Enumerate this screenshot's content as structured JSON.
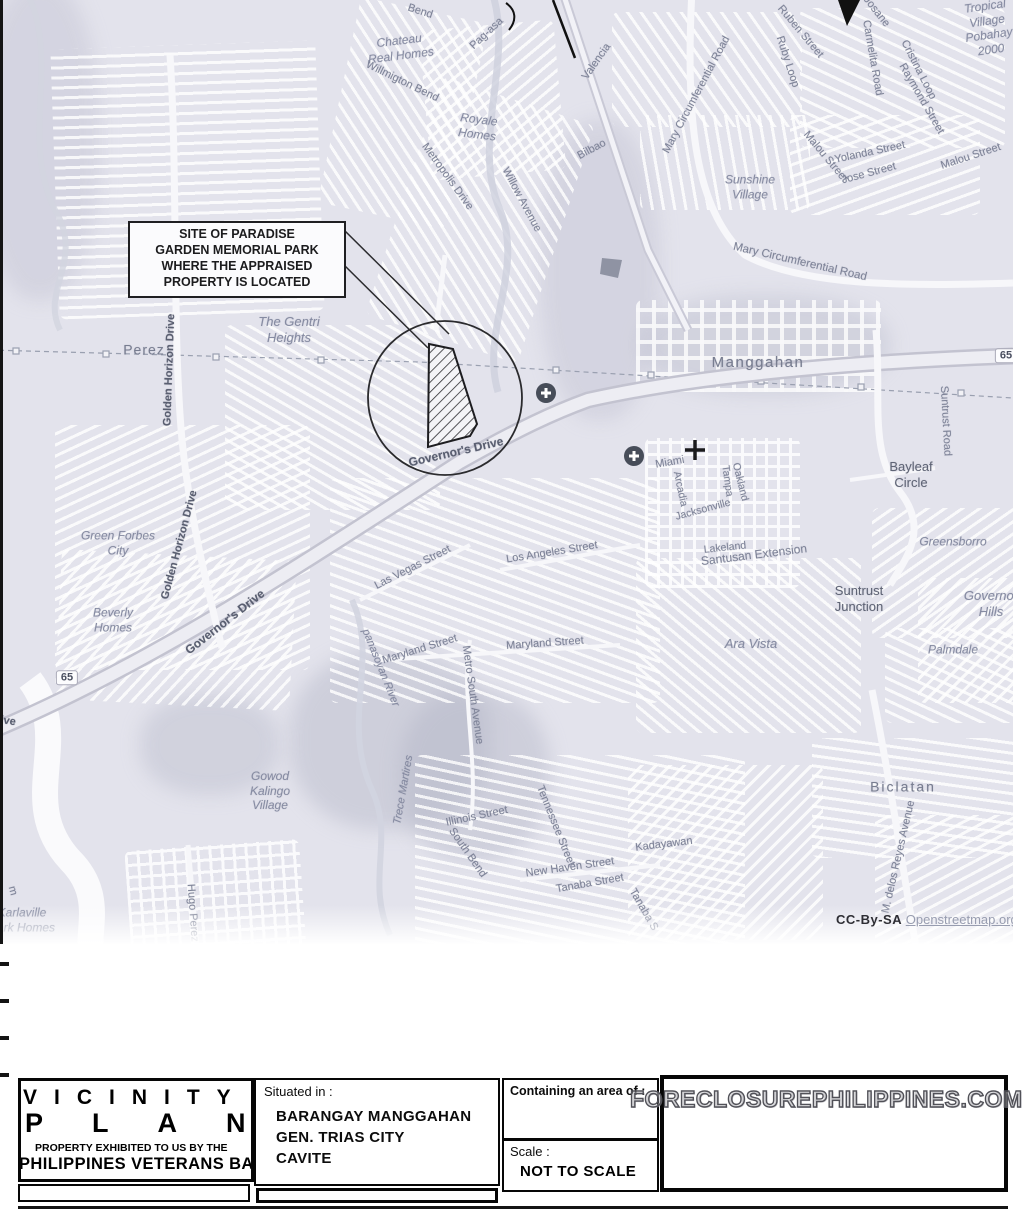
{
  "map": {
    "callout_text": "SITE OF PARADISE\nGARDEN MEMORIAL PARK\nWHERE THE APPRAISED\nPROPERTY IS LOCATED",
    "attribution": {
      "prefix": "CC-By-SA",
      "link": "Openstreetmap.org"
    },
    "labels": [
      {
        "t": "Bend",
        "x": 420,
        "y": 12,
        "r": 18,
        "s": 11,
        "c": "road"
      },
      {
        "t": "Pag-asa",
        "x": 487,
        "y": 34,
        "r": -43,
        "s": 11,
        "c": "road"
      },
      {
        "t": "Chateau\nReal Homes",
        "x": 400,
        "y": 48,
        "r": -7,
        "s": 12,
        "c": "place"
      },
      {
        "t": "Willmigton Bend",
        "x": 402,
        "y": 82,
        "r": 26,
        "s": 11,
        "c": "road"
      },
      {
        "t": "Royale\nHomes",
        "x": 478,
        "y": 127,
        "r": 7,
        "s": 12,
        "c": "place"
      },
      {
        "t": "Metropolis Drive",
        "x": 447,
        "y": 177,
        "r": 54,
        "s": 11,
        "c": "road"
      },
      {
        "t": "Willow Avenue",
        "x": 521,
        "y": 200,
        "r": 62,
        "s": 11,
        "c": "road"
      },
      {
        "t": "Valencia",
        "x": 597,
        "y": 62,
        "r": -55,
        "s": 11,
        "c": "road"
      },
      {
        "t": "Bilbao",
        "x": 592,
        "y": 150,
        "r": -28,
        "s": 11,
        "c": "road"
      },
      {
        "t": "Mary Circumferential Road",
        "x": 697,
        "y": 95,
        "r": -62,
        "s": 11,
        "c": "road"
      },
      {
        "t": "Ruben Street",
        "x": 800,
        "y": 32,
        "r": 50,
        "s": 11,
        "c": "road"
      },
      {
        "t": "Ruby Loop",
        "x": 787,
        "y": 62,
        "r": 72,
        "s": 11,
        "c": "road"
      },
      {
        "t": "Josane",
        "x": 876,
        "y": 12,
        "r": 52,
        "s": 11,
        "c": "road"
      },
      {
        "t": "Carmelita Road",
        "x": 872,
        "y": 58,
        "r": 80,
        "s": 11,
        "c": "road"
      },
      {
        "t": "Cristina Loop",
        "x": 918,
        "y": 70,
        "r": 63,
        "s": 11,
        "c": "road"
      },
      {
        "t": "Raymond Street",
        "x": 921,
        "y": 99,
        "r": 60,
        "s": 11,
        "c": "road"
      },
      {
        "t": "Tropical\nVillage\nPobahay\n2000",
        "x": 988,
        "y": 28,
        "r": -8,
        "s": 12,
        "c": "place"
      },
      {
        "t": "Malou Street",
        "x": 825,
        "y": 157,
        "r": 50,
        "s": 11,
        "c": "road"
      },
      {
        "t": "Yolanda Street",
        "x": 870,
        "y": 153,
        "r": -12,
        "s": 11,
        "c": "road"
      },
      {
        "t": "Jose Street",
        "x": 869,
        "y": 174,
        "r": -15,
        "s": 11,
        "c": "road"
      },
      {
        "t": "Malou Street",
        "x": 971,
        "y": 157,
        "r": -18,
        "s": 11,
        "c": "road"
      },
      {
        "t": "Sunshine\nVillage",
        "x": 750,
        "y": 187,
        "r": 0,
        "s": 12,
        "c": "place"
      },
      {
        "t": "Mary Circumferential Road",
        "x": 800,
        "y": 262,
        "r": 13,
        "s": 11.5,
        "c": "road"
      },
      {
        "t": "Manggahan",
        "x": 758,
        "y": 363,
        "r": 0,
        "s": 15,
        "c": "town",
        "ls": 1.5
      },
      {
        "t": "65",
        "x": 67,
        "y": 678,
        "r": 0,
        "s": 11,
        "c": "shield"
      },
      {
        "t": "65",
        "x": 1006,
        "y": 356,
        "r": 0,
        "s": 11,
        "c": "shield"
      },
      {
        "t": "Suntrust Road",
        "x": 945,
        "y": 421,
        "r": 87,
        "s": 11,
        "c": "road"
      },
      {
        "t": "Bayleaf\nCircle",
        "x": 911,
        "y": 475,
        "r": 0,
        "s": 13,
        "c": "dark"
      },
      {
        "t": "Greensborro",
        "x": 953,
        "y": 542,
        "r": 0,
        "s": 12,
        "c": "place"
      },
      {
        "t": "Governor\nHills",
        "x": 991,
        "y": 604,
        "r": 0,
        "s": 13,
        "c": "place"
      },
      {
        "t": "Suntrust\nJunction",
        "x": 859,
        "y": 599,
        "r": 0,
        "s": 13,
        "c": "dark"
      },
      {
        "t": "Palmdale",
        "x": 953,
        "y": 650,
        "r": 0,
        "s": 12,
        "c": "place"
      },
      {
        "t": "Ara Vista",
        "x": 751,
        "y": 644,
        "r": 0,
        "s": 13,
        "c": "place"
      },
      {
        "t": "Governor's Drive",
        "x": 456,
        "y": 452,
        "r": -13,
        "s": 12,
        "c": "road-dark"
      },
      {
        "t": "Governor's Drive",
        "x": 225,
        "y": 622,
        "r": -38,
        "s": 12,
        "c": "road-dark"
      },
      {
        "t": "Golden Horizon Drive",
        "x": 170,
        "y": 370,
        "r": -88,
        "s": 11,
        "c": "road-dark"
      },
      {
        "t": "Golden Horizon Drive",
        "x": 180,
        "y": 545,
        "r": -75,
        "s": 11,
        "c": "road-dark"
      },
      {
        "t": "Drive",
        "x": 2,
        "y": 721,
        "r": 8,
        "s": 11,
        "c": "road-dark"
      },
      {
        "t": "Perez",
        "x": 144,
        "y": 350,
        "r": 0,
        "s": 14,
        "c": "town",
        "ls": 1
      },
      {
        "t": "The Gentri\nHeights",
        "x": 289,
        "y": 330,
        "r": 0,
        "s": 13,
        "c": "place"
      },
      {
        "t": "Green Forbes\nCity",
        "x": 118,
        "y": 543,
        "r": 0,
        "s": 12,
        "c": "place"
      },
      {
        "t": "Beverly\nHomes",
        "x": 113,
        "y": 620,
        "r": 0,
        "s": 12,
        "c": "place"
      },
      {
        "t": "Miami",
        "x": 670,
        "y": 463,
        "r": -10,
        "s": 11,
        "c": "road"
      },
      {
        "t": "Arcadia",
        "x": 680,
        "y": 489,
        "r": 78,
        "s": 10.5,
        "c": "road"
      },
      {
        "t": "Jacksonville",
        "x": 703,
        "y": 510,
        "r": -15,
        "s": 10.5,
        "c": "road"
      },
      {
        "t": "Tampa",
        "x": 727,
        "y": 481,
        "r": 82,
        "s": 10.5,
        "c": "road"
      },
      {
        "t": "Oakland",
        "x": 740,
        "y": 482,
        "r": 76,
        "s": 10.5,
        "c": "road"
      },
      {
        "t": "Lakeland",
        "x": 725,
        "y": 548,
        "r": -6,
        "s": 10.5,
        "c": "road"
      },
      {
        "t": "Santusan Extension",
        "x": 754,
        "y": 555,
        "r": -7,
        "s": 12,
        "c": "road"
      },
      {
        "t": "Las Vegas Street",
        "x": 413,
        "y": 568,
        "r": -27,
        "s": 11,
        "c": "road"
      },
      {
        "t": "Los Angeles Street",
        "x": 552,
        "y": 553,
        "r": -9,
        "s": 11,
        "c": "road"
      },
      {
        "t": "Maryland Street",
        "x": 420,
        "y": 650,
        "r": -17,
        "s": 11,
        "c": "road"
      },
      {
        "t": "Maryland Street",
        "x": 545,
        "y": 644,
        "r": -4,
        "s": 11,
        "c": "road"
      },
      {
        "t": "Metro South Avenue",
        "x": 472,
        "y": 695,
        "r": 82,
        "s": 11,
        "c": "road"
      },
      {
        "t": "panasoyan River",
        "x": 380,
        "y": 668,
        "r": 68,
        "s": 11,
        "c": "river"
      },
      {
        "t": "Trece Martires",
        "x": 404,
        "y": 790,
        "r": -80,
        "s": 11,
        "c": "river"
      },
      {
        "t": "Illinois Street",
        "x": 477,
        "y": 817,
        "r": -12,
        "s": 11,
        "c": "road"
      },
      {
        "t": "South Bend",
        "x": 467,
        "y": 853,
        "r": 55,
        "s": 11,
        "c": "road"
      },
      {
        "t": "Tennessee Street",
        "x": 555,
        "y": 826,
        "r": 68,
        "s": 11,
        "c": "road"
      },
      {
        "t": "New Haven Street",
        "x": 570,
        "y": 868,
        "r": -8,
        "s": 11,
        "c": "road"
      },
      {
        "t": "Tanaba Street",
        "x": 590,
        "y": 884,
        "r": -10,
        "s": 11,
        "c": "road"
      },
      {
        "t": "Tanaba S",
        "x": 643,
        "y": 910,
        "r": 60,
        "s": 11,
        "c": "road"
      },
      {
        "t": "Kadayawan",
        "x": 664,
        "y": 845,
        "r": -7,
        "s": 11,
        "c": "road"
      },
      {
        "t": "Gowod\nKalingo\nVillage",
        "x": 270,
        "y": 791,
        "r": 0,
        "s": 12,
        "c": "place"
      },
      {
        "t": "Karlaville\nPark Homes",
        "x": 22,
        "y": 920,
        "r": 0,
        "s": 12,
        "c": "place"
      },
      {
        "t": "Hugo Perez",
        "x": 192,
        "y": 913,
        "r": 86,
        "s": 11,
        "c": "road"
      },
      {
        "t": "m",
        "x": 12,
        "y": 891,
        "r": 75,
        "s": 11,
        "c": "road"
      },
      {
        "t": "Biclatan",
        "x": 903,
        "y": 787,
        "r": 0,
        "s": 14,
        "c": "town",
        "ls": 2
      },
      {
        "t": "M. delos Reyes Avenue",
        "x": 899,
        "y": 857,
        "r": -77,
        "s": 11,
        "c": "road"
      }
    ]
  },
  "title_block": {
    "title_line1": "VICINITY",
    "title_line2": "PLAN",
    "exhibited_line1": "PROPERTY EXHIBITED TO US BY THE",
    "exhibited_line2": "PHILIPPINES VETERANS BANK",
    "situated_label": "Situated in :",
    "situated_value": "BARANGAY MANGGAHAN\nGEN. TRIAS CITY\nCAVITE",
    "area_label": "Containing an area of :",
    "scale_label": "Scale :",
    "scale_value": "NOT TO SCALE",
    "watermark": "FORECLOSUREPHILIPPINES.COM"
  }
}
